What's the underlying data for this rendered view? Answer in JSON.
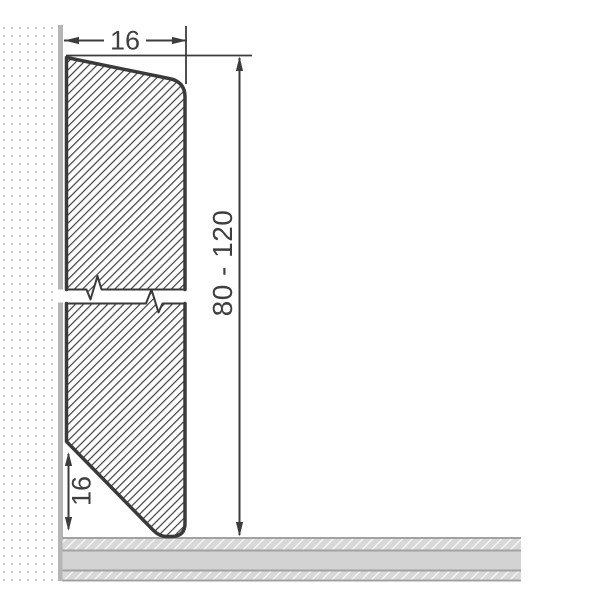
{
  "labels": {
    "width": "16",
    "height": "80 - 120",
    "bottom_chamfer": "16"
  },
  "colors": {
    "outline": "#3a3a3a",
    "dimension_lines": "#3c3c3c",
    "label_text": "#3f3f3f",
    "wall_stripe": "#b5b5b5",
    "wall_dots": "#c7c7c7",
    "floor_band": "#d8d8d8",
    "floor_mid_band": "#d3d3d3",
    "floor_lines": "#a2a2a2",
    "background": "#ffffff"
  }
}
